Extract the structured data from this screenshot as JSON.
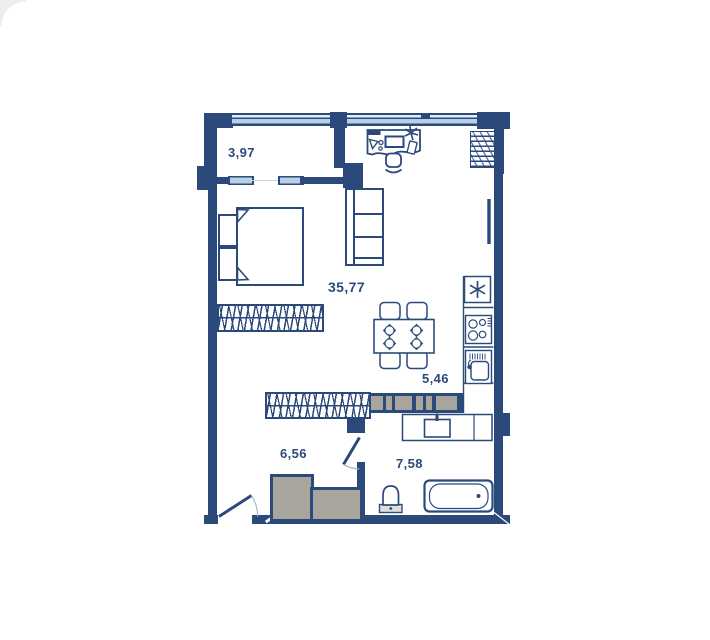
{
  "plan": {
    "rooms": [
      {
        "name": "balcony",
        "area_label": "3,97"
      },
      {
        "name": "living-room",
        "area_label": "35,77"
      },
      {
        "name": "kitchen",
        "area_label": "5,46"
      },
      {
        "name": "hallway",
        "area_label": "6,56"
      },
      {
        "name": "bathroom",
        "area_label": "7,58"
      }
    ]
  },
  "colors": {
    "wall": "#2b4a7b",
    "win": "#b9cfe6",
    "winpale": "#e3edf7",
    "gray": "#a8a59d",
    "label": "#2b4a7b",
    "arc": "#9db0cc",
    "tank": "#e0dfdb"
  }
}
